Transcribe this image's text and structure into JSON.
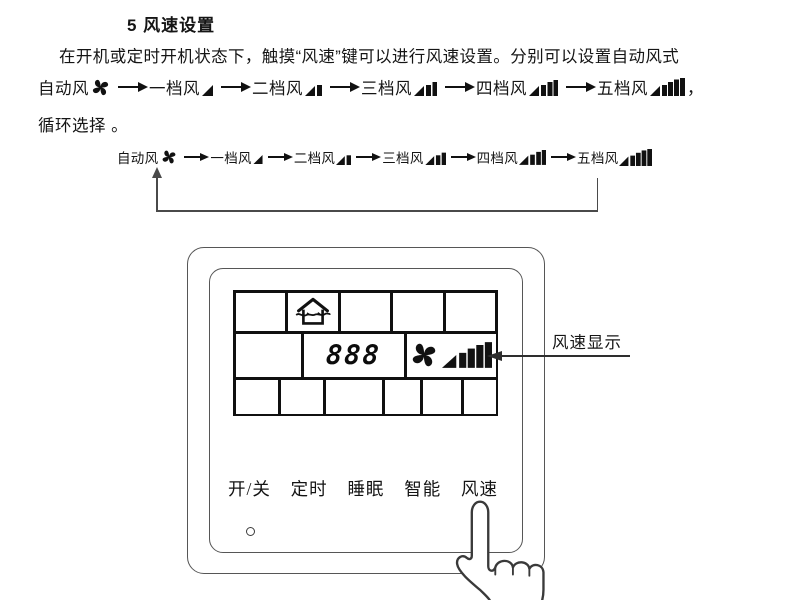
{
  "title": "5 风速设置",
  "paragraph": {
    "line1": "在开机或定时开机状态下，触摸“风速”键可以进行风速设置。分别可以设置自动风式",
    "line2_tail": "，",
    "line3": "循环选择 。"
  },
  "wind_modes": [
    "自动风",
    "一档风",
    "二档风",
    "三档风",
    "四档风",
    "五档风"
  ],
  "panel": {
    "display_value": "888",
    "annotation": "风速显示",
    "buttons": [
      "开/关",
      "定时",
      "睡眠",
      "智能",
      "风速"
    ]
  },
  "colors": {
    "ink": "#151515",
    "line": "#4a4a4a"
  }
}
